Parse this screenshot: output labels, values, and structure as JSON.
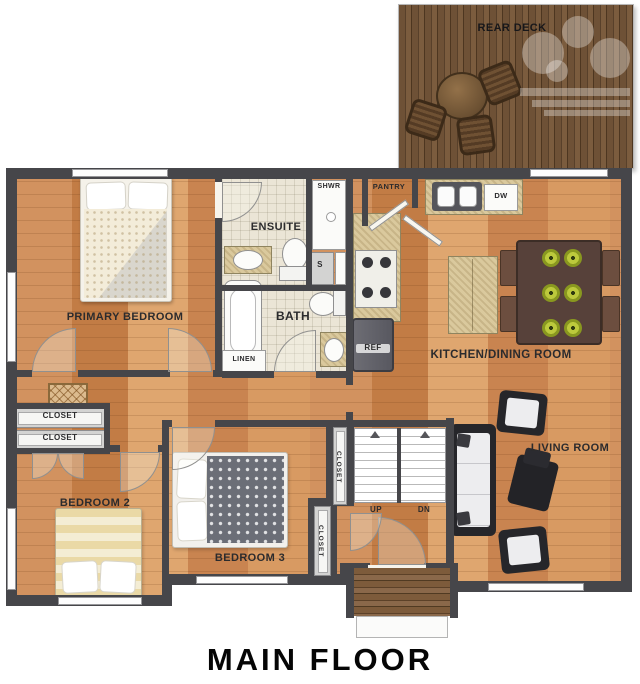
{
  "title": "MAIN FLOOR",
  "colors": {
    "wall": "#46464a",
    "floor_wood": "#d2925f",
    "deck_wood": "#6e5136",
    "tile": "#ebe5d6",
    "counter": "#dac99d",
    "dining_table": "#57413a",
    "plate_green": "#bcc93c",
    "label_text": "#2b2b2d"
  },
  "labels": {
    "rear_deck": "REAR DECK",
    "primary_bedroom": "PRIMARY BEDROOM",
    "ensuite": "ENSUITE",
    "shower": "SHWR",
    "storage": "S",
    "bath": "BATH",
    "linen": "LINEN",
    "pantry": "PANTRY",
    "dishwasher": "DW",
    "refrigerator": "REF",
    "kitchen_dining": "KITCHEN/DINING ROOM",
    "living_room": "LIVING ROOM",
    "closet_hall_top": "CLOSET",
    "closet_hall_bottom": "CLOSET",
    "closet_stairs": "CLOSET",
    "closet_bedroom3": "CLOSET",
    "bedroom2": "BEDROOM 2",
    "bedroom3": "BEDROOM 3",
    "stairs_up": "UP",
    "stairs_down": "DN"
  }
}
